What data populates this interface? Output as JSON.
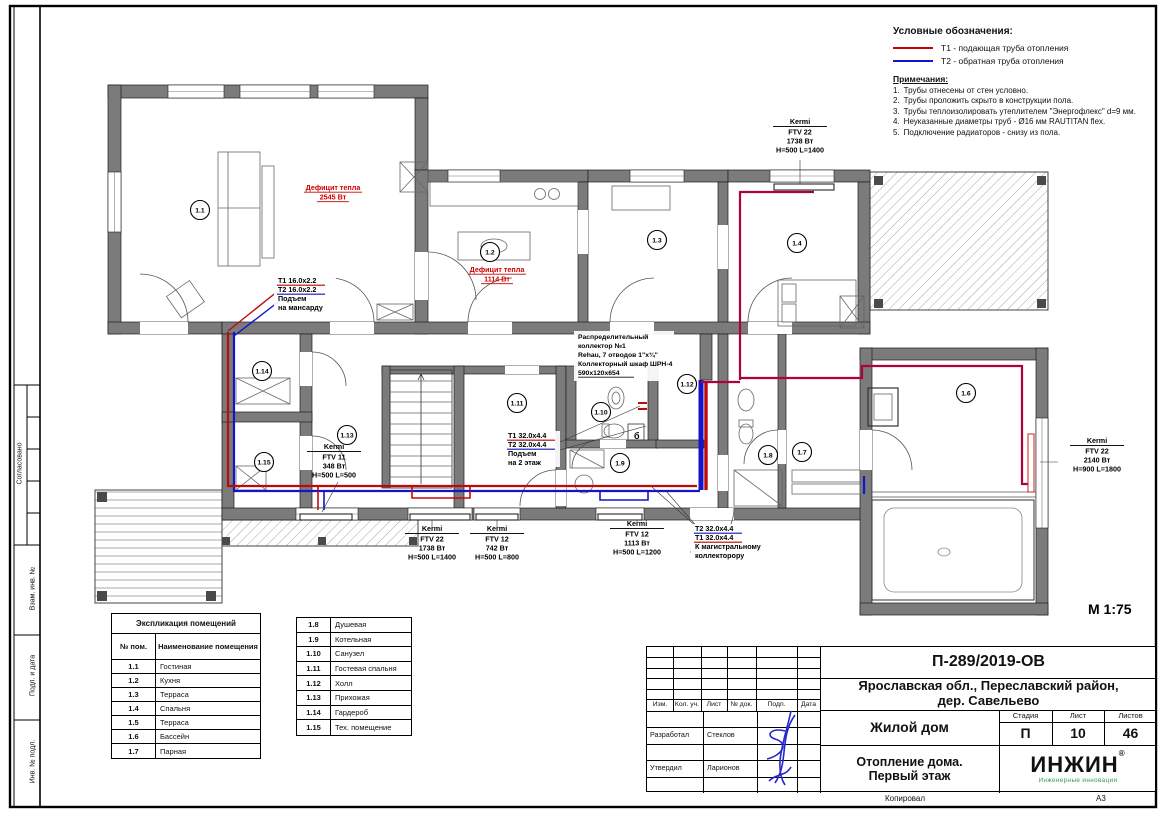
{
  "sheet": {
    "scale": "М 1:75",
    "copied": "Копировал",
    "format": "А3"
  },
  "side_stamp": {
    "agreed": "Согласовано",
    "vzam": "Взам. инв. №",
    "podp": "Подп. и дата",
    "inv": "Инв. № подл."
  },
  "legend": {
    "title": "Условные обозначения:",
    "items": [
      {
        "label": "Т1 - подающая труба отопления",
        "color": "#cc0000"
      },
      {
        "label": "Т2 - обратная труба отопления",
        "color": "#1414cc"
      }
    ],
    "notes_title": "Примечания:",
    "notes": [
      {
        "num": "1.",
        "text": "Трубы отнесены от стен условно."
      },
      {
        "num": "2.",
        "text": "Трубы проложить скрыто в конструкции пола."
      },
      {
        "num": "3.",
        "text": "Трубы теплоизолировать утеплителем \"Энергофлекс\" d=9 мм."
      },
      {
        "num": "4.",
        "text": "Неуказанные диаметры труб - Ø16 мм RAUTITAN flex."
      },
      {
        "num": "5.",
        "text": "Подключение радиаторов - снизу из пола."
      }
    ]
  },
  "plan": {
    "boiler_mark": "б",
    "room_markers": [
      {
        "id": "1.1",
        "x": 200,
        "y": 210
      },
      {
        "id": "1.2",
        "x": 490,
        "y": 252
      },
      {
        "id": "1.3",
        "x": 657,
        "y": 240
      },
      {
        "id": "1.4",
        "x": 797,
        "y": 243
      },
      {
        "id": "1.14",
        "x": 262,
        "y": 371
      },
      {
        "id": "1.15",
        "x": 264,
        "y": 462
      },
      {
        "id": "1.13",
        "x": 347,
        "y": 435
      },
      {
        "id": "1.11",
        "x": 517,
        "y": 403
      },
      {
        "id": "1.10",
        "x": 601,
        "y": 412
      },
      {
        "id": "1.12",
        "x": 687,
        "y": 384
      },
      {
        "id": "1.9",
        "x": 620,
        "y": 463
      },
      {
        "id": "1.8",
        "x": 768,
        "y": 455
      },
      {
        "id": "1.7",
        "x": 802,
        "y": 452
      },
      {
        "id": "1.6",
        "x": 966,
        "y": 393
      }
    ],
    "radiator_labels": [
      {
        "x": 800,
        "y": 124,
        "brand": "Kermi",
        "model": "FTV 22",
        "power": "1738 Вт",
        "size": "H=500 L=1400"
      },
      {
        "x": 432,
        "y": 531,
        "brand": "Kermi",
        "model": "FTV 22",
        "power": "1738 Вт",
        "size": "H=500 L=1400"
      },
      {
        "x": 497,
        "y": 531,
        "brand": "Kermi",
        "model": "FTV 12",
        "power": "742 Вт",
        "size": "H=500 L=800"
      },
      {
        "x": 637,
        "y": 526,
        "brand": "Kermi",
        "model": "FTV 12",
        "power": "1113 Вт",
        "size": "H=500 L=1200"
      },
      {
        "x": 334,
        "y": 449,
        "brand": "Kermi",
        "model": "FTV 11",
        "power": "348 Вт",
        "size": "H=500 L=500"
      },
      {
        "x": 1097,
        "y": 443,
        "brand": "Kermi",
        "model": "FTV 22",
        "power": "2140 Вт",
        "size": "H=900 L=1800"
      }
    ],
    "pipe_labels": [
      {
        "x": 278,
        "y": 283,
        "lines": [
          {
            "t": "Т1 16.0х2.2",
            "u": "#bb0000"
          },
          {
            "t": "Т2 16.0х2.2",
            "u": "#1414bb"
          },
          {
            "t": "Подъем"
          },
          {
            "t": "на мансарду"
          }
        ]
      },
      {
        "x": 508,
        "y": 438,
        "lines": [
          {
            "t": "Т1 32.0х4.4",
            "u": "#bb0000"
          },
          {
            "t": "Т2 32.0х4.4",
            "u": "#1414bb"
          },
          {
            "t": "Подъем"
          },
          {
            "t": "на 2 этаж"
          }
        ]
      },
      {
        "x": 695,
        "y": 531,
        "lines": [
          {
            "t": "Т2 32.0х4.4",
            "u": "#1414bb"
          },
          {
            "t": "Т1 32.0х4.4",
            "u": "#bb0000"
          },
          {
            "t": "К магистральному"
          },
          {
            "t": "коллекторору"
          }
        ]
      }
    ],
    "manifold_label": {
      "x": 578,
      "y": 339,
      "lines": [
        "Распределительный",
        "коллектор №1",
        "Rehau, 7 отводов 1\"х¾\"",
        "Коллекторный шкаф ШРН-4",
        "590х120х654"
      ]
    },
    "deficit_labels": [
      {
        "x": 333,
        "y": 190,
        "lines": [
          "Дефицит тепла",
          "2545 Вт"
        ]
      },
      {
        "x": 497,
        "y": 272,
        "lines": [
          "Дефицит тепла",
          "1114 Вт"
        ]
      }
    ]
  },
  "tables": {
    "explication": {
      "title": "Экспликация помещений",
      "col1": "№ пом.",
      "col2": "Наименование помещения",
      "rows": [
        [
          "1.1",
          "Гостиная"
        ],
        [
          "1.2",
          "Кухня"
        ],
        [
          "1.3",
          "Терраса"
        ],
        [
          "1.4",
          "Спальня"
        ],
        [
          "1.5",
          "Терраса"
        ],
        [
          "1.6",
          "Бассейн"
        ],
        [
          "1.7",
          "Парная"
        ]
      ]
    },
    "explication2_rows": [
      [
        "1.8",
        "Душевая"
      ],
      [
        "1.9",
        "Котельная"
      ],
      [
        "1.10",
        "Санузел"
      ],
      [
        "1.11",
        "Гостевая спальня"
      ],
      [
        "1.12",
        "Холл"
      ],
      [
        "1.13",
        "Прихожая"
      ],
      [
        "1.14",
        "Гардероб"
      ],
      [
        "1.15",
        "Тех. помещение"
      ]
    ]
  },
  "title_block": {
    "doc_number": "П-289/2019-ОВ",
    "address_line1": "Ярославская обл., Переславский район,",
    "address_line2": "дер. Савельево",
    "object": "Жилой дом",
    "sheet_title_line1": "Отопление дома.",
    "sheet_title_line2": "Первый этаж",
    "stage_label": "Стадия",
    "sheet_label": "Лист",
    "sheets_label": "Листов",
    "stage": "П",
    "sheet": "10",
    "sheets": "46",
    "cols": [
      "Изм.",
      "Кол. уч.",
      "Лист",
      "№ док.",
      "Подп.",
      "Дата"
    ],
    "rows": [
      {
        "role": "Разработал",
        "name": "Стеклов"
      },
      {
        "role": "Утвердил",
        "name": "Ларионов"
      }
    ],
    "logo_text": "ИНЖИН",
    "logo_r": "®",
    "logo_sub": "Инженерные инновации"
  }
}
